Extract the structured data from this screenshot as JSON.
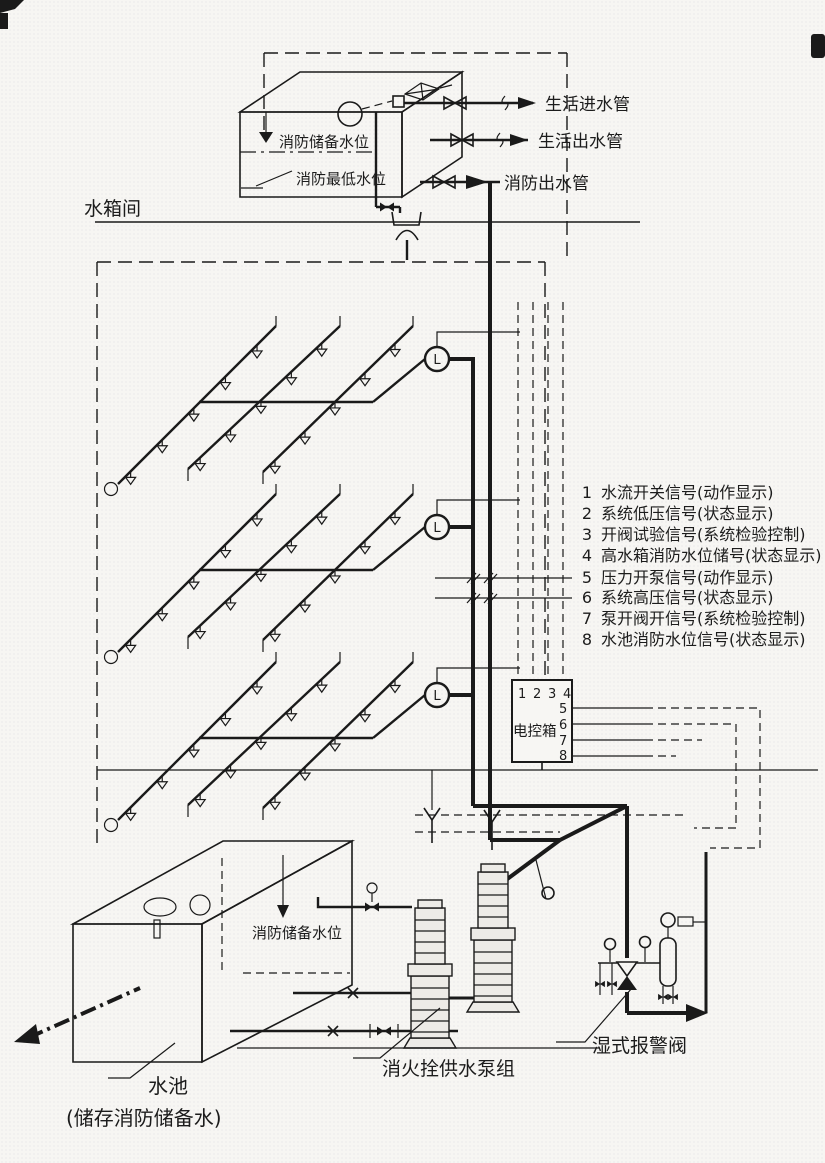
{
  "diagram": {
    "room_label": "水箱间",
    "tank": {
      "reserve_level_label": "消防储备水位",
      "lowest_level_label": "消防最低水位"
    },
    "outlet_pipes": {
      "domestic_inlet": "生活进水管",
      "domestic_outlet": "生活出水管",
      "fire_outlet": "消防出水管"
    },
    "flow_indicator_label": "L",
    "signal_legend": [
      {
        "no": "1",
        "label": "水流开关信号(动作显示)"
      },
      {
        "no": "2",
        "label": "系统低压信号(状态显示)"
      },
      {
        "no": "3",
        "label": "开阀试验信号(系统检验控制)"
      },
      {
        "no": "4",
        "label": "高水箱消防水位储号(状态显示)"
      },
      {
        "no": "5",
        "label": "压力开泵信号(动作显示)"
      },
      {
        "no": "6",
        "label": "系统高压信号(状态显示)"
      },
      {
        "no": "7",
        "label": "泵开阀开信号(系统检验控制)"
      },
      {
        "no": "8",
        "label": "水池消防水位信号(状态显示)"
      }
    ],
    "control_box": {
      "label": "电控箱",
      "top_ports": [
        "1",
        "2",
        "3",
        "4"
      ],
      "side_ports": [
        "5",
        "6",
        "7",
        "8"
      ]
    },
    "pool": {
      "reserve_level_label": "消防储备水位",
      "name": "水池",
      "note": "(储存消防储备水)"
    },
    "pump_group_label": "消火拴供水泵组",
    "wet_alarm_valve_label": "湿式报警阀"
  }
}
